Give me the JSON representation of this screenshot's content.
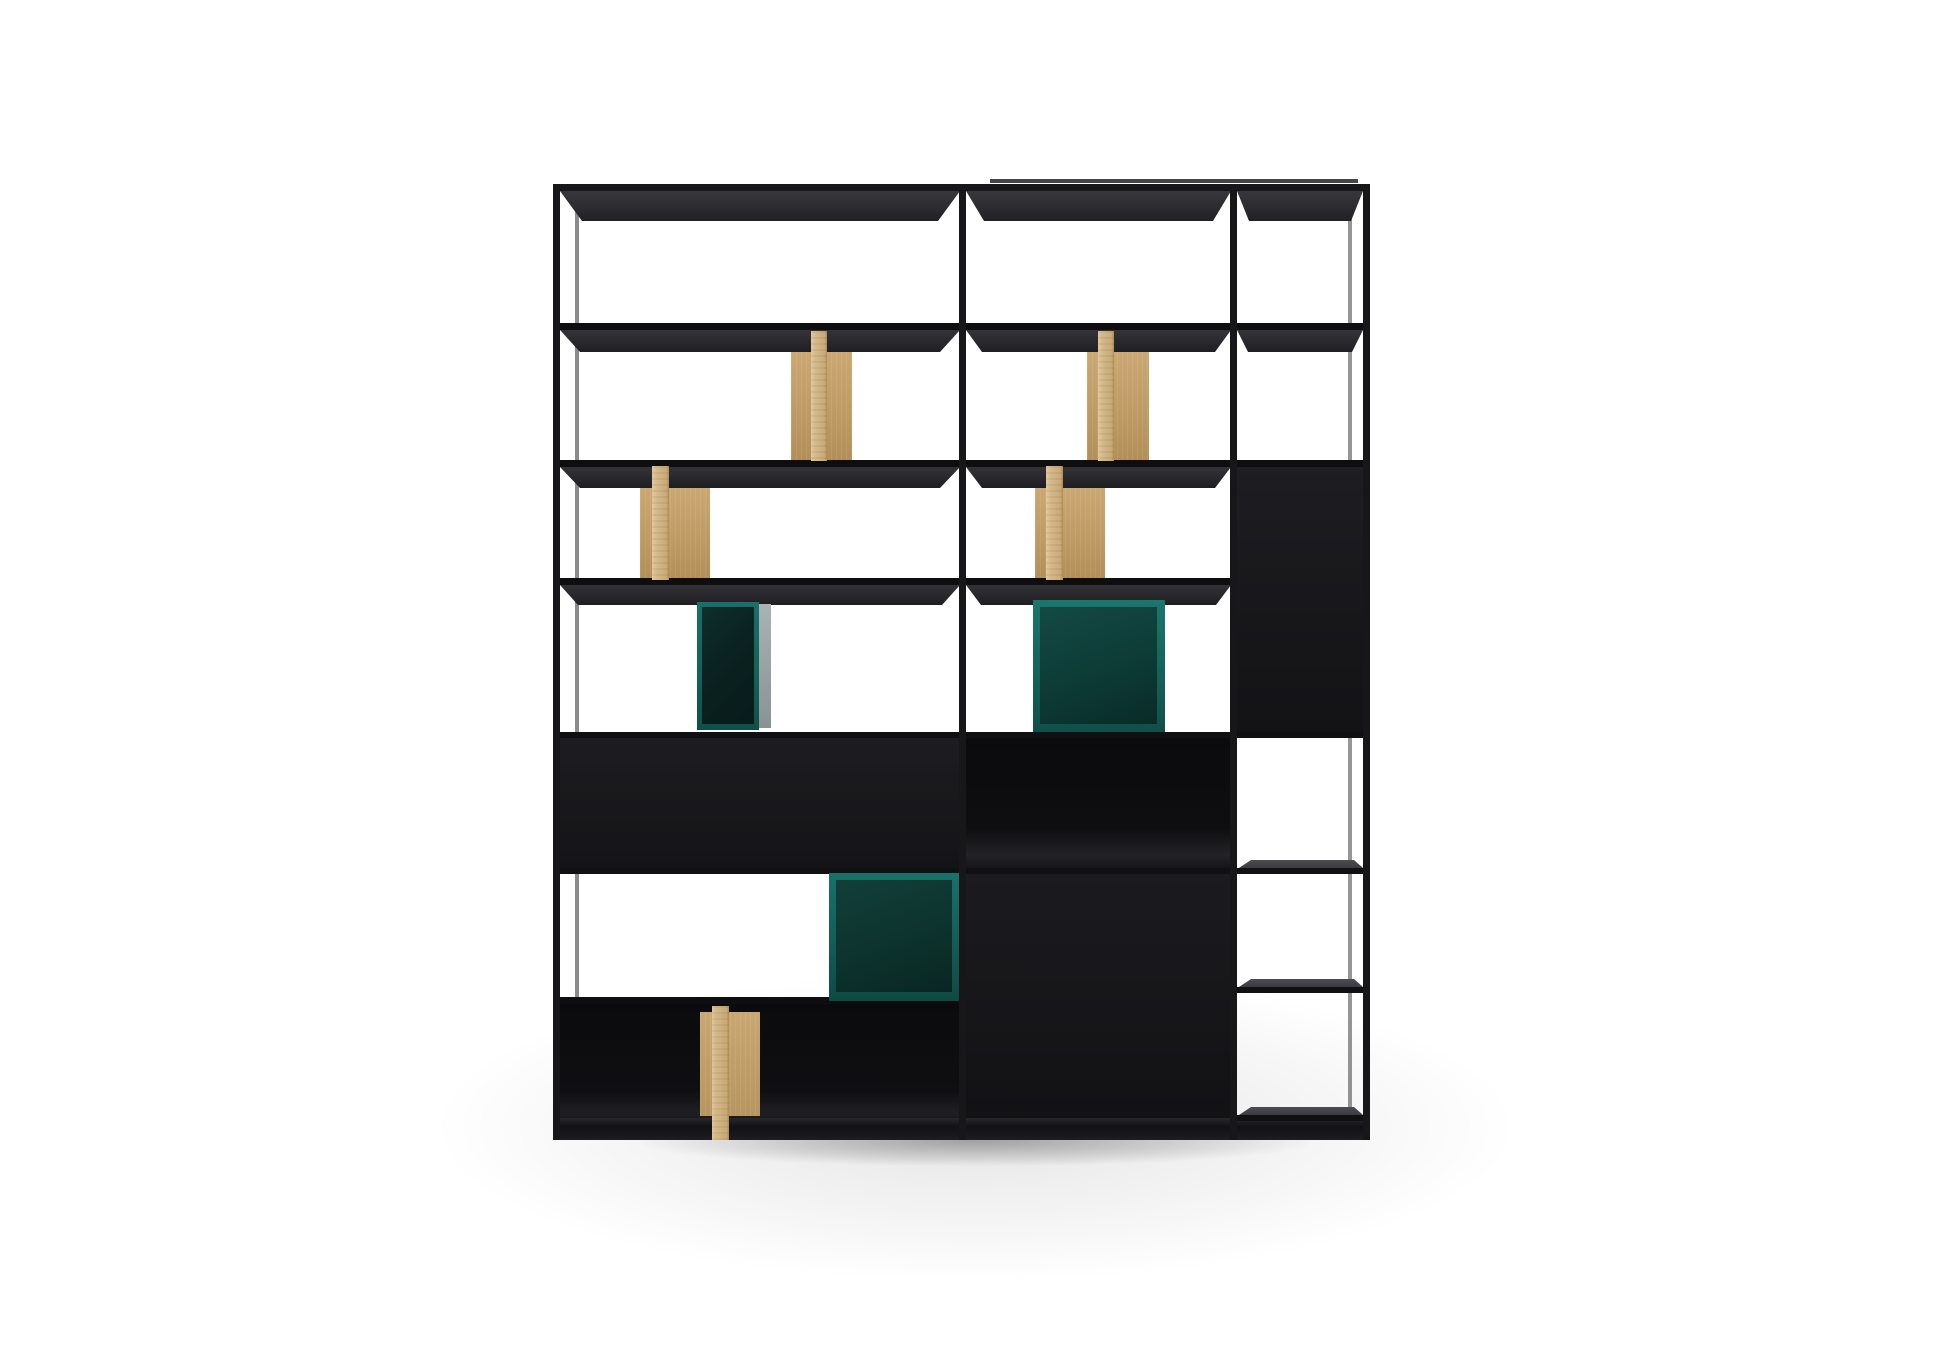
{
  "scene": {
    "canvas": {
      "w": 1946,
      "h": 1355
    },
    "background": "#ffffff",
    "palette": {
      "frame": "#17171a",
      "rail": "#0e0e10",
      "shelf_underside": "#2b2b30",
      "shelf_top_face": "#46464b",
      "cabinet_black": "#18181b",
      "compartment_interior": "#0c0c0e",
      "wood_face": "#d5b98a",
      "wood_panel": "#c19e66",
      "teal_frame": "#17726b",
      "teal_interior_dark": "#0a2423",
      "teal_interior_mid": "#0e3f3a",
      "box_side_gray": "#9aa3a4",
      "shadow": "rgba(0,0,0,0.28)"
    },
    "elements": [
      {
        "name": "floor-wash",
        "x": 250,
        "y": 940,
        "w": 1450,
        "h": 415,
        "bg": "radial-gradient(ellipse 50% 50% at 50% 45%, rgba(0,0,0,0.10) 0%, rgba(0,0,0,0.04) 48%, rgba(0,0,0,0) 75%)"
      },
      {
        "name": "contact-shadow",
        "x": 500,
        "y": 1112,
        "w": 950,
        "h": 70,
        "bg": "radial-gradient(ellipse 50% 50% at 50% 42%, rgba(0,0,0,0.30) 0%, rgba(0,0,0,0.12) 45%, rgba(0,0,0,0) 72%)"
      },
      {
        "name": "back-top-rail",
        "x": 990,
        "y": 179,
        "w": 368,
        "h": 4,
        "bg": "rgba(23,23,26,0.80)"
      },
      {
        "name": "left-back-post",
        "x": 575,
        "y": 191,
        "w": 4,
        "h": 931,
        "bg": "rgba(23,23,26,0.50)"
      },
      {
        "name": "right-back-post",
        "x": 1348,
        "y": 191,
        "w": 4,
        "h": 920,
        "bg": "rgba(23,23,26,0.45)"
      },
      {
        "name": "top-shelf-underside-left",
        "x": 560,
        "y": 191,
        "w": 400,
        "h": 30,
        "bg": "linear-gradient(180deg,#37373c 0%,#2b2b30 55%,#212125 100%)",
        "clip": "polygon(0 0, 100% 0, calc(100% - 22px) 100%, 22px 100%)"
      },
      {
        "name": "top-shelf-underside-middle",
        "x": 966,
        "y": 191,
        "w": 265,
        "h": 30,
        "bg": "linear-gradient(180deg,#37373c 0%,#2b2b30 55%,#212125 100%)",
        "clip": "polygon(0 0, 100% 0, calc(100% - 18px) 100%, 18px 100%)"
      },
      {
        "name": "top-shelf-underside-right",
        "x": 1237,
        "y": 191,
        "w": 126,
        "h": 30,
        "bg": "linear-gradient(180deg,#37373c 0%,#2b2b30 55%,#212125 100%)",
        "clip": "polygon(0 0, 100% 0, calc(100% - 12px) 100%, 12px 100%)"
      },
      {
        "name": "shelf2-rail",
        "x": 553,
        "y": 323,
        "w": 817,
        "h": 7,
        "bg": "#0e0e10"
      },
      {
        "name": "shelf2-underside-left",
        "x": 560,
        "y": 330,
        "w": 400,
        "h": 22,
        "bg": "linear-gradient(180deg,#333338 0%,#28282c 60%,#1f1f23 100%)",
        "clip": "polygon(0 0, 100% 0, calc(100% - 20px) 100%, 20px 100%)"
      },
      {
        "name": "shelf2-underside-middle",
        "x": 966,
        "y": 330,
        "w": 265,
        "h": 22,
        "bg": "linear-gradient(180deg,#333338 0%,#28282c 60%,#1f1f23 100%)",
        "clip": "polygon(0 0, 100% 0, calc(100% - 16px) 100%, 16px 100%)"
      },
      {
        "name": "shelf2-underside-right",
        "x": 1237,
        "y": 330,
        "w": 126,
        "h": 22,
        "bg": "linear-gradient(180deg,#333338 0%,#28282c 60%,#1f1f23 100%)",
        "clip": "polygon(0 0, 100% 0, calc(100% - 11px) 100%, 11px 100%)"
      },
      {
        "name": "right-column-panel",
        "x": 1237,
        "y": 460,
        "w": 133,
        "h": 272,
        "bg": "linear-gradient(180deg,#1e1e22 0%,#17171a 60%,#131316 100%)"
      },
      {
        "name": "shelf3-rail",
        "x": 553,
        "y": 460,
        "w": 817,
        "h": 7,
        "bg": "#0e0e10"
      },
      {
        "name": "shelf3-underside-left",
        "x": 560,
        "y": 467,
        "w": 400,
        "h": 21,
        "bg": "linear-gradient(180deg,#323237 0%,#27272b 60%,#1e1e22 100%)",
        "clip": "polygon(0 0, 100% 0, calc(100% - 20px) 100%, 20px 100%)"
      },
      {
        "name": "shelf3-underside-middle",
        "x": 966,
        "y": 467,
        "w": 265,
        "h": 21,
        "bg": "linear-gradient(180deg,#323237 0%,#27272b 60%,#1e1e22 100%)",
        "clip": "polygon(0 0, 100% 0, calc(100% - 16px) 100%, 16px 100%)"
      },
      {
        "name": "shelf4-rail",
        "x": 553,
        "y": 578,
        "w": 684,
        "h": 7,
        "bg": "#0e0e10"
      },
      {
        "name": "shelf4-underside-left",
        "x": 560,
        "y": 585,
        "w": 400,
        "h": 20,
        "bg": "linear-gradient(180deg,#323237 0%,#27272b 60%,#1e1e22 100%)",
        "clip": "polygon(0 0, 100% 0, calc(100% - 18px) 100%, 18px 100%)"
      },
      {
        "name": "shelf4-underside-middle",
        "x": 966,
        "y": 585,
        "w": 265,
        "h": 20,
        "bg": "linear-gradient(180deg,#323237 0%,#27272b 60%,#1e1e22 100%)",
        "clip": "polygon(0 0, 100% 0, calc(100% - 15px) 100%, 15px 100%)"
      },
      {
        "name": "shelf5-rail",
        "x": 553,
        "y": 732,
        "w": 817,
        "h": 6,
        "bg": "#101013"
      },
      {
        "name": "left-closed-cabinet",
        "x": 558,
        "y": 738,
        "w": 404,
        "h": 133,
        "bg": "linear-gradient(180deg,#1d1d21 0%,#18181b 55%,#141417 100%)"
      },
      {
        "name": "middle-open-compartment",
        "x": 966,
        "y": 738,
        "w": 266,
        "h": 133,
        "bg": "linear-gradient(180deg,#0b0b0d 0%,#0e0e10 68%,#232327 88%,#131316 100%)"
      },
      {
        "name": "shelf6-rail",
        "x": 553,
        "y": 868,
        "w": 684,
        "h": 6,
        "bg": "#101013"
      },
      {
        "name": "middle-tall-cabinet",
        "x": 966,
        "y": 874,
        "w": 266,
        "h": 263,
        "bg": "linear-gradient(180deg,#1b1b1f 0%,#161619 55%,#111114 100%)"
      },
      {
        "name": "shelf7-rail-left",
        "x": 553,
        "y": 997,
        "w": 409,
        "h": 7,
        "bg": "#0e0e10"
      },
      {
        "name": "bottom-open-compartment",
        "x": 558,
        "y": 1004,
        "w": 404,
        "h": 121,
        "bg": "linear-gradient(180deg,#0b0b0d 0%,#0f0f12 72%,#202024 90%,#111114 100%)"
      },
      {
        "name": "base-plinth",
        "x": 553,
        "y": 1118,
        "w": 817,
        "h": 22,
        "bg": "linear-gradient(180deg,#27272b 0%,#121215 40%,#1d1d21 100%)"
      },
      {
        "name": "bottom-divider-wood-panel",
        "x": 700,
        "y": 1012,
        "w": 60,
        "h": 104,
        "bg": "repeating-linear-gradient(90deg, rgba(255,255,255,0.08) 0 1px, rgba(0,0,0,0) 1px 5px), linear-gradient(180deg,#c9a770 0%,#b7955f 100%)"
      },
      {
        "name": "bottom-divider-wood-board",
        "x": 712,
        "y": 1006,
        "w": 17,
        "h": 134,
        "bg": "repeating-linear-gradient(180deg, rgba(0,0,0,0.05) 0 2px, rgba(0,0,0,0) 2px 6px), linear-gradient(90deg,#e0c79c 0%,#d5b98a 20%,#c8a975 85%,#b08d56 100%)"
      },
      {
        "name": "row2-divider-wood-panel-left",
        "x": 791,
        "y": 352,
        "w": 61,
        "h": 108,
        "bg": "repeating-linear-gradient(90deg, rgba(255,255,255,0.08) 0 1px, rgba(0,0,0,0) 1px 5px), linear-gradient(180deg,#cba873 0%,#bd9a63 60%,#b28f58 100%)"
      },
      {
        "name": "row2-divider-wood-board-left",
        "x": 811,
        "y": 331,
        "w": 16,
        "h": 130,
        "bg": "repeating-linear-gradient(180deg, rgba(0,0,0,0.05) 0 2px, rgba(0,0,0,0) 2px 6px), linear-gradient(90deg,#e2c99e 0%,#d6ba8c 25%,#c9aa77 85%,#b08d56 100%)"
      },
      {
        "name": "row2-divider-wood-panel-middle",
        "x": 1087,
        "y": 352,
        "w": 62,
        "h": 108,
        "bg": "repeating-linear-gradient(90deg, rgba(255,255,255,0.08) 0 1px, rgba(0,0,0,0) 1px 5px), linear-gradient(180deg,#cba873 0%,#bd9a63 60%,#b28f58 100%)"
      },
      {
        "name": "row2-divider-wood-board-middle",
        "x": 1098,
        "y": 331,
        "w": 16,
        "h": 130,
        "bg": "repeating-linear-gradient(180deg, rgba(0,0,0,0.05) 0 2px, rgba(0,0,0,0) 2px 6px), linear-gradient(90deg,#e2c99e 0%,#d6ba8c 25%,#c9aa77 85%,#b08d56 100%)"
      },
      {
        "name": "row3-divider-wood-panel-left",
        "x": 640,
        "y": 488,
        "w": 70,
        "h": 90,
        "bg": "repeating-linear-gradient(90deg, rgba(255,255,255,0.08) 0 1px, rgba(0,0,0,0) 1px 5px), linear-gradient(180deg,#cba873 0%,#bd9a63 60%,#b28f58 100%)"
      },
      {
        "name": "row3-divider-wood-board-left",
        "x": 652,
        "y": 466,
        "w": 17,
        "h": 114,
        "bg": "repeating-linear-gradient(180deg, rgba(0,0,0,0.05) 0 2px, rgba(0,0,0,0) 2px 6px), linear-gradient(90deg,#e2c99e 0%,#d6ba8c 25%,#c9aa77 85%,#b08d56 100%)"
      },
      {
        "name": "row3-divider-wood-panel-middle",
        "x": 1035,
        "y": 488,
        "w": 70,
        "h": 90,
        "bg": "repeating-linear-gradient(90deg, rgba(255,255,255,0.08) 0 1px, rgba(0,0,0,0) 1px 5px), linear-gradient(180deg,#cba873 0%,#bd9a63 60%,#b28f58 100%)"
      },
      {
        "name": "row3-divider-wood-board-middle",
        "x": 1046,
        "y": 466,
        "w": 17,
        "h": 114,
        "bg": "repeating-linear-gradient(180deg, rgba(0,0,0,0.05) 0 2px, rgba(0,0,0,0) 2px 6px), linear-gradient(90deg,#e2c99e 0%,#d6ba8c 25%,#c9aa77 85%,#b08d56 100%)"
      },
      {
        "name": "teal-box-small-frame",
        "x": 697,
        "y": 602,
        "w": 62,
        "h": 128,
        "bg": "linear-gradient(180deg,#1a6f68 0%,#14625c 55%,#0f4f4a 100%)"
      },
      {
        "name": "teal-box-small-interior",
        "x": 702,
        "y": 607,
        "w": 52,
        "h": 117,
        "bg": "linear-gradient(135deg,#0e2e2c 0%,#0a2221 45%,#071b1a 100%)"
      },
      {
        "name": "teal-box-small-side",
        "x": 759,
        "y": 604,
        "w": 12,
        "h": 124,
        "bg": "linear-gradient(180deg,#aab3b4 0%,#98a1a2 55%,#8a9394 100%)"
      },
      {
        "name": "teal-box-middle-frame",
        "x": 1033,
        "y": 600,
        "w": 132,
        "h": 132,
        "bg": "linear-gradient(180deg,#1b766e 0%,#156059 60%,#104f49 100%)"
      },
      {
        "name": "teal-box-middle-interior",
        "x": 1040,
        "y": 607,
        "w": 117,
        "h": 117,
        "bg": "linear-gradient(160deg,#134a44 0%,#0d3b36 55%,#092b27 100%)"
      },
      {
        "name": "teal-box-bottom-frame",
        "x": 829,
        "y": 873,
        "w": 131,
        "h": 128,
        "bg": "linear-gradient(180deg,#19716a 0%,#135b55 60%,#0e4a44 100%)"
      },
      {
        "name": "teal-box-bottom-interior",
        "x": 836,
        "y": 880,
        "w": 116,
        "h": 112,
        "bg": "linear-gradient(160deg,#123f39 0%,#0d332e 55%,#092621 100%)"
      },
      {
        "name": "right-shelf1-top-face",
        "x": 1239,
        "y": 860,
        "w": 124,
        "h": 8,
        "bg": "linear-gradient(180deg,#4c4c52 0%,#3a3a3f 100%)",
        "clip": "polygon(12px 0, calc(100% - 9px) 0, 100% 100%, 0 100%)"
      },
      {
        "name": "right-shelf1-edge",
        "x": 1237,
        "y": 868,
        "w": 126,
        "h": 6,
        "bg": "#101013"
      },
      {
        "name": "right-shelf2-top-face",
        "x": 1239,
        "y": 979,
        "w": 124,
        "h": 8,
        "bg": "linear-gradient(180deg,#4c4c52 0%,#3a3a3f 100%)",
        "clip": "polygon(12px 0, calc(100% - 9px) 0, 100% 100%, 0 100%)"
      },
      {
        "name": "right-shelf2-edge",
        "x": 1237,
        "y": 987,
        "w": 126,
        "h": 6,
        "bg": "#101013"
      },
      {
        "name": "right-shelf3-top-face",
        "x": 1239,
        "y": 1107,
        "w": 124,
        "h": 8,
        "bg": "linear-gradient(180deg,#4c4c52 0%,#3a3a3f 100%)",
        "clip": "polygon(12px 0, calc(100% - 9px) 0, 100% 100%, 0 100%)"
      },
      {
        "name": "right-shelf3-edge",
        "x": 1237,
        "y": 1115,
        "w": 126,
        "h": 6,
        "bg": "#101013"
      },
      {
        "name": "frame-top-rail",
        "x": 553,
        "y": 184,
        "w": 817,
        "h": 7,
        "bg": "#17171a"
      },
      {
        "name": "frame-post-left",
        "x": 553,
        "y": 184,
        "w": 7,
        "h": 956,
        "bg": "#17171a"
      },
      {
        "name": "frame-post-divider1",
        "x": 959,
        "y": 184,
        "w": 7,
        "h": 956,
        "bg": "#17171a"
      },
      {
        "name": "frame-post-divider2",
        "x": 1230,
        "y": 184,
        "w": 7,
        "h": 956,
        "bg": "#17171a"
      },
      {
        "name": "frame-post-right",
        "x": 1363,
        "y": 184,
        "w": 7,
        "h": 956,
        "bg": "#17171a"
      }
    ]
  }
}
